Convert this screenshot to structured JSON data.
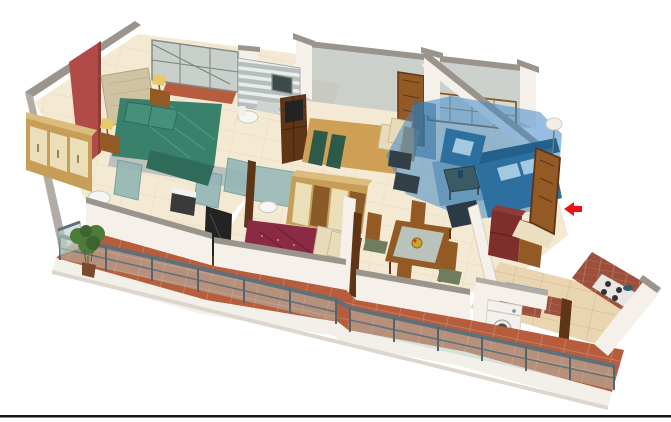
{
  "meta": {
    "kind": "isometric-3d-floorplan-render",
    "description": "3D cutaway rendering of a 3-bedroom apartment floor plan on a white background with a thin black rule near the bottom edge",
    "width_px": 671,
    "height_px": 422
  },
  "palette": {
    "background": "#ffffff",
    "bottom_rule": "#151515",
    "wall_face": "#f5f1ea",
    "wall_face_bright": "#fbf9f6",
    "wall_shadow": "#e3dcd2",
    "wall_cap": "#9b948c",
    "wall_cap_light": "#b3aca4",
    "accent_wall": "#b04b47",
    "floor_cream": "#ecdfc0",
    "floor_cream_light": "#f4ead3",
    "kitchen_floor": "#e9d6b0",
    "balcony_tile": "#b55d3c",
    "highlight_overlay": "#4189c6",
    "highlight_wall": "#2f6f9e",
    "sofa_blue": "#2d6f9f",
    "sofa_back": "#24608c",
    "sofa_cushion": "#a3c9e0",
    "bed_green": "#3a816b",
    "bed_green_dark": "#2e6b59",
    "bed_maroon": "#8a2a45",
    "bed_maroon_dark": "#6e1f36",
    "bed_tan": "#cf9f55",
    "throw_green": "#2e5a49",
    "pillow_cream": "#e8dbb9",
    "headboard_cream": "#cfc3a2",
    "wood": "#935a26",
    "wood_dark": "#5f3517",
    "wardrobe_wood": "#c69e58",
    "wardrobe_top": "#dcbc7c",
    "wardrobe_panel": "#ebdfba",
    "counter_brick": "#9c4f3a",
    "sink_counter": "#7fa9c0",
    "sink_basin": "#5f8ca6",
    "fridge_maroon": "#7e2f2b",
    "fridge_top": "#8f3b36",
    "appliance_white": "#f2f1ee",
    "appliance_door": "#4a4a4a",
    "bath_teal": "#93b7b6",
    "bath_tile": "#b2bab9",
    "glass_pane": "#b9cec6",
    "railing_metal": "#5f7079",
    "post_metal": "#55656e",
    "back_glass": "#c9cfca",
    "back_glass_light": "#d6dbd5",
    "frame_wood": "#8a5a2a",
    "plant_green": "#4d7c3a",
    "plant_green_dark": "#3c6330",
    "pot_brown": "#7a4a2a",
    "lamp_yellow": "#e8c96a",
    "tv_black": "#232323",
    "rug_gold": "#d8c279",
    "rug_blue": "#3e7ba8",
    "table_glass": "#bcc9c3",
    "chair_seat": "#6f7d5c",
    "arrow_red": "#ee1111",
    "fascia_white": "#f3f0ea",
    "fascia_shadow": "#dcd6cd"
  },
  "scene": {
    "highlighted_room": {
      "name": "living-room",
      "overlay_color": "#4189c6"
    },
    "entrance_marker": {
      "type": "arrow",
      "direction": "left",
      "color": "#ee1111",
      "position": "right-edge-near-entry-door"
    },
    "rooms": [
      {
        "name": "master-bedroom",
        "features": [
          "red accent wall",
          "double bed with green bedding",
          "cream tufted headboard",
          "two nightstands with lamps",
          "light-wood wardrobe"
        ]
      },
      {
        "name": "master-bathroom",
        "features": [
          "gray tiled wall",
          "teal glass shower partitions",
          "toilet",
          "dark washbasin unit"
        ]
      },
      {
        "name": "bathroom-2",
        "features": [
          "striped gray tiled wall",
          "toilet",
          "small window"
        ]
      },
      {
        "name": "bedroom-2",
        "features": [
          "tan double bed",
          "dark green foot throws",
          "cream pillows",
          "dark wardrobe",
          "wall TV"
        ]
      },
      {
        "name": "living-room",
        "features": [
          "blue selection overlay",
          "L-shaped blue sofa",
          "blue armchair",
          "coffee table",
          "floor lamp",
          "side tables"
        ]
      },
      {
        "name": "bedroom-3",
        "features": [
          "maroon patterned double bed",
          "cream and wood wardrobe",
          "TV on low unit",
          "gold rug",
          "wooden panel"
        ]
      },
      {
        "name": "dining-area",
        "features": [
          "glass-top wooden dining table",
          "four wooden chairs",
          "fruit bowl centerpiece"
        ]
      },
      {
        "name": "kitchen",
        "features": [
          "brick-faced L counter",
          "gas hob",
          "blue sink counter",
          "maroon refrigerator",
          "tall cabinet"
        ]
      },
      {
        "name": "utility-balcony",
        "features": [
          "white front-load washing machine"
        ]
      },
      {
        "name": "front-balcony",
        "features": [
          "terracotta tile floor",
          "glass and metal railing with step",
          "potted plant at left corner"
        ]
      },
      {
        "name": "rear-balconies",
        "features": [
          "glazed gray-green window walls",
          "terracotta sills",
          "open wooden doors"
        ]
      }
    ]
  }
}
